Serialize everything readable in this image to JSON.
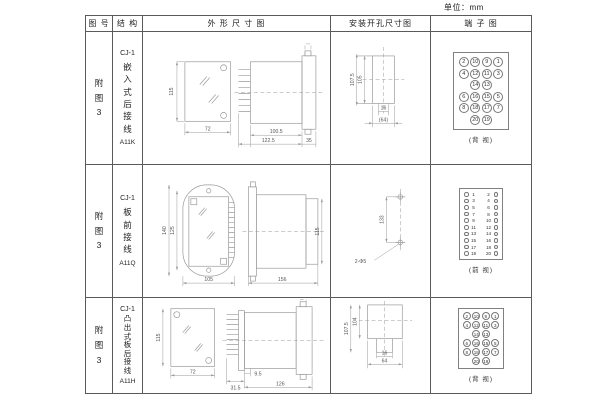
{
  "page": {
    "unit_label": "单位：mm"
  },
  "table": {
    "headers": {
      "figure_no": "图 号",
      "structure": "结 构",
      "outline": "外 形 尺 寸 图",
      "install": "安装开孔尺寸图",
      "terminal": "端 子 图"
    },
    "rows": [
      {
        "figure_no": "附图3",
        "model": "CJ-1",
        "structure_name": "嵌入式后接线",
        "code": "A11K",
        "outline": {
          "front_height": "115",
          "front_width": "72",
          "body_length": "100.5",
          "total_length": "122.5",
          "flange_depth": "35"
        },
        "install": {
          "outer_height": "107.5",
          "inner_height": "105",
          "slot_width": "16",
          "hole_span": "(64)"
        },
        "terminal": {
          "caption": "(背 视)"
        }
      },
      {
        "figure_no": "附图3",
        "model": "CJ-1",
        "structure_name": "板前接线",
        "code": "A11Q",
        "outline": {
          "outer_height": "140",
          "inner_height": "125",
          "front_width": "105",
          "body_length": "156",
          "side_height": "115"
        },
        "install": {
          "hole_spacing": "133",
          "hole_label": "2-Φ5"
        },
        "terminal": {
          "caption": "(前 视)"
        }
      },
      {
        "figure_no": "附图3",
        "model": "CJ-1",
        "structure_name": "凸出式板后接线",
        "code": "A11H",
        "outline": {
          "front_height": "115",
          "front_width": "72",
          "pin_depth": "31.5",
          "step": "9.5",
          "body_length": "126"
        },
        "install": {
          "outer_height": "107.5",
          "inner_height": "104",
          "slot_width": "16",
          "hole_span": "64"
        },
        "terminal": {
          "caption": "(背 视)"
        }
      }
    ],
    "terminal_grid": [
      [
        "2",
        "10",
        "9",
        "1"
      ],
      [
        "4",
        "12",
        "11",
        "3"
      ],
      [
        "",
        "14",
        "13",
        ""
      ],
      [
        "6",
        "16",
        "15",
        "5"
      ],
      [
        "8",
        "18",
        "17",
        "7"
      ],
      [
        "",
        "20",
        "19",
        ""
      ]
    ],
    "terminal_strip_left": [
      "1",
      "3",
      "5",
      "7",
      "9",
      "11",
      "13",
      "15",
      "17",
      "19"
    ],
    "terminal_strip_right": [
      "2",
      "4",
      "6",
      "8",
      "10",
      "12",
      "14",
      "16",
      "18",
      "20"
    ]
  }
}
